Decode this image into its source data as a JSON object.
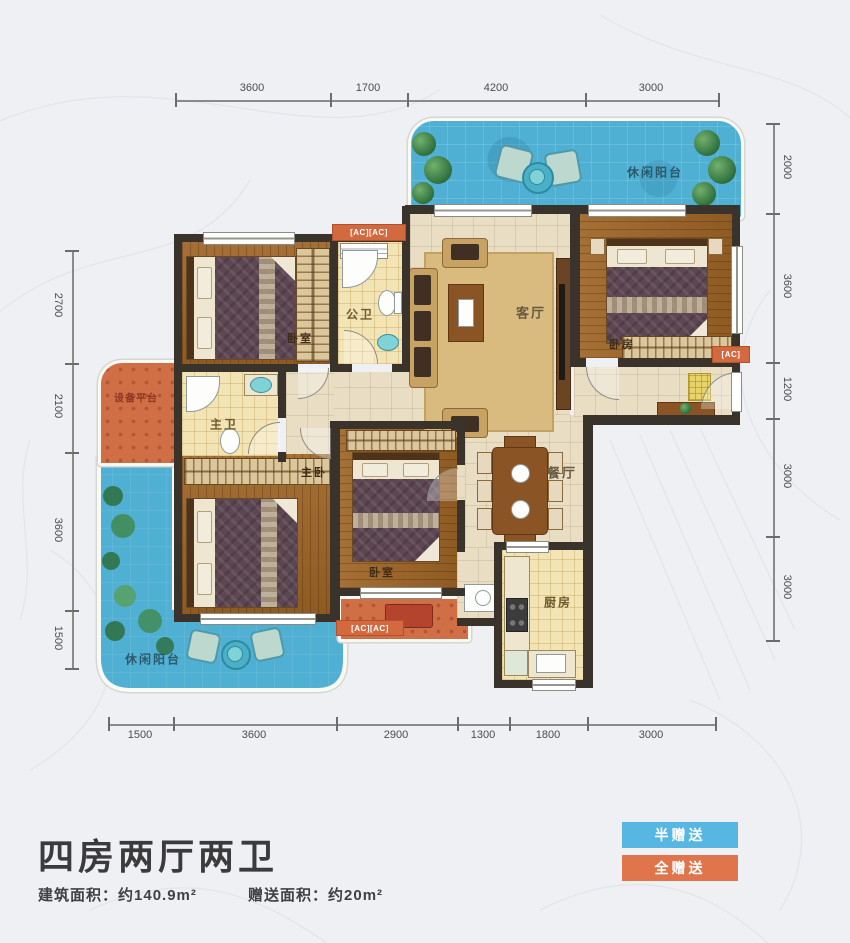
{
  "title": "四房两厅两卫",
  "stats": {
    "area_label": "建筑面积：",
    "area_value": "约140.9m²",
    "gift_label": "赠送面积：",
    "gift_value": "约20m²"
  },
  "legend": {
    "half": "半赠送",
    "full": "全赠送"
  },
  "colors": {
    "half_gift": "#58b7e2",
    "full_gift": "#e0754b",
    "balcony": "#4fb0d4",
    "wall": "#3a332c"
  },
  "dims": {
    "top": [
      "3600",
      "1700",
      "4200",
      "3000"
    ],
    "bottom": [
      "1500",
      "3600",
      "2900",
      "1300",
      "1800",
      "3000"
    ],
    "left": [
      "2700",
      "2100",
      "3600",
      "1500"
    ],
    "right": [
      "2000",
      "3600",
      "1200",
      "3000",
      "3000"
    ]
  },
  "rooms": {
    "balcony_top": "休闲阳台",
    "bedroom_tl": "卧室",
    "guest_bath": "公卫",
    "living": "客厅",
    "bedroom_r": "卧房",
    "equipment": "设备平台",
    "master_bath": "主卫",
    "master_bed": "主卧",
    "bedroom_mid": "卧室",
    "dining": "餐厅",
    "kitchen": "厨房",
    "balcony_bl": "休闲阳台"
  },
  "badges": {
    "ac_top": "[AC][AC]",
    "ac_right": "[AC]",
    "ac_bottom": "[AC][AC]"
  }
}
